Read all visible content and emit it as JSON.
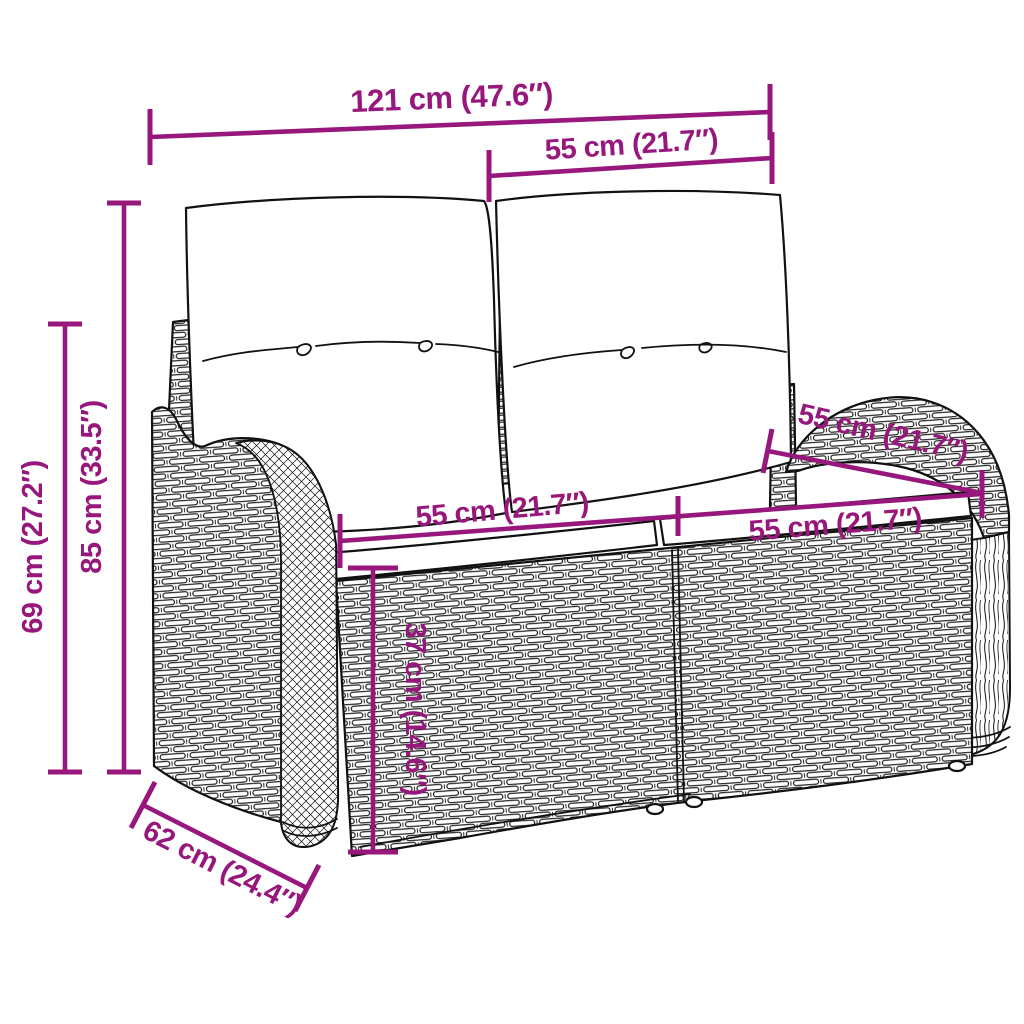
{
  "page": {
    "title": "Garden bench dimension diagram",
    "background": "#ffffff"
  },
  "style": {
    "annotation_color": "#97177D",
    "line_art_color": "#111111"
  },
  "product": {
    "description": "Two-seater poly rattan garden bench with back cushions and seat cushions",
    "view": "three-quarter front line drawing with dimension callouts"
  },
  "dims": {
    "total_width": "121 cm (47.6″)",
    "back_cushion_width": "55 cm (21.7″)",
    "total_height": "85 cm (33.5″)",
    "armrest_height": "69 cm (27.2″)",
    "seat_width_left": "55 cm (21.7″)",
    "seat_width_right": "55 cm (21.7″)",
    "seat_depth": "55 cm (21.7″)",
    "seat_height": "37 cm (14.6″)",
    "total_depth": "62 cm (24.4″)"
  }
}
